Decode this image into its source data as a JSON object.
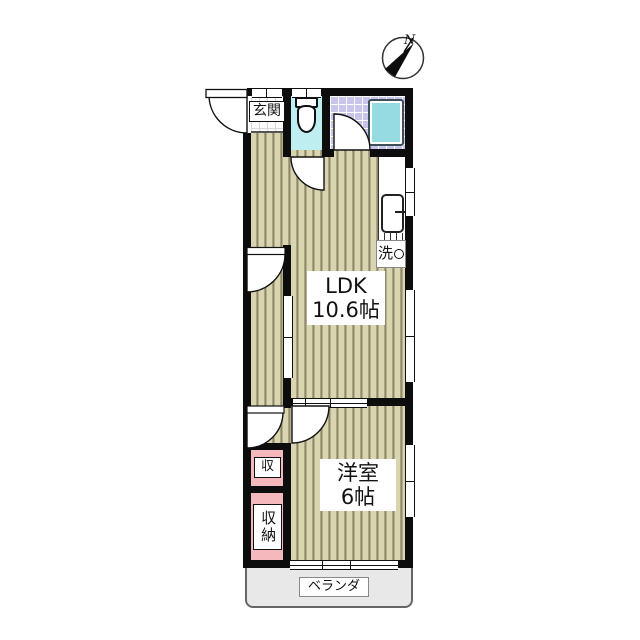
{
  "compass": {
    "north_label": "N"
  },
  "rooms": {
    "entrance": {
      "label": "玄関"
    },
    "ldk": {
      "name": "LDK",
      "size": "10.6帖"
    },
    "western_room": {
      "name": "洋室",
      "size": "6帖"
    },
    "laundry": {
      "label": "洗"
    },
    "storage": {
      "label": "収"
    },
    "closet": {
      "label": "収納"
    },
    "veranda": {
      "label": "ベランダ"
    }
  },
  "colors": {
    "wall": "#0d0d0d",
    "wood_floor": "#d9d3ae",
    "wood_stripe": "#8e8968",
    "bath_tile": "#c9c5ea",
    "bathtub": "#96dbe2",
    "toilet_floor": "#bfeef1",
    "closet_pink": "#f5b9bd",
    "veranda_gray": "#e8e8e8"
  }
}
